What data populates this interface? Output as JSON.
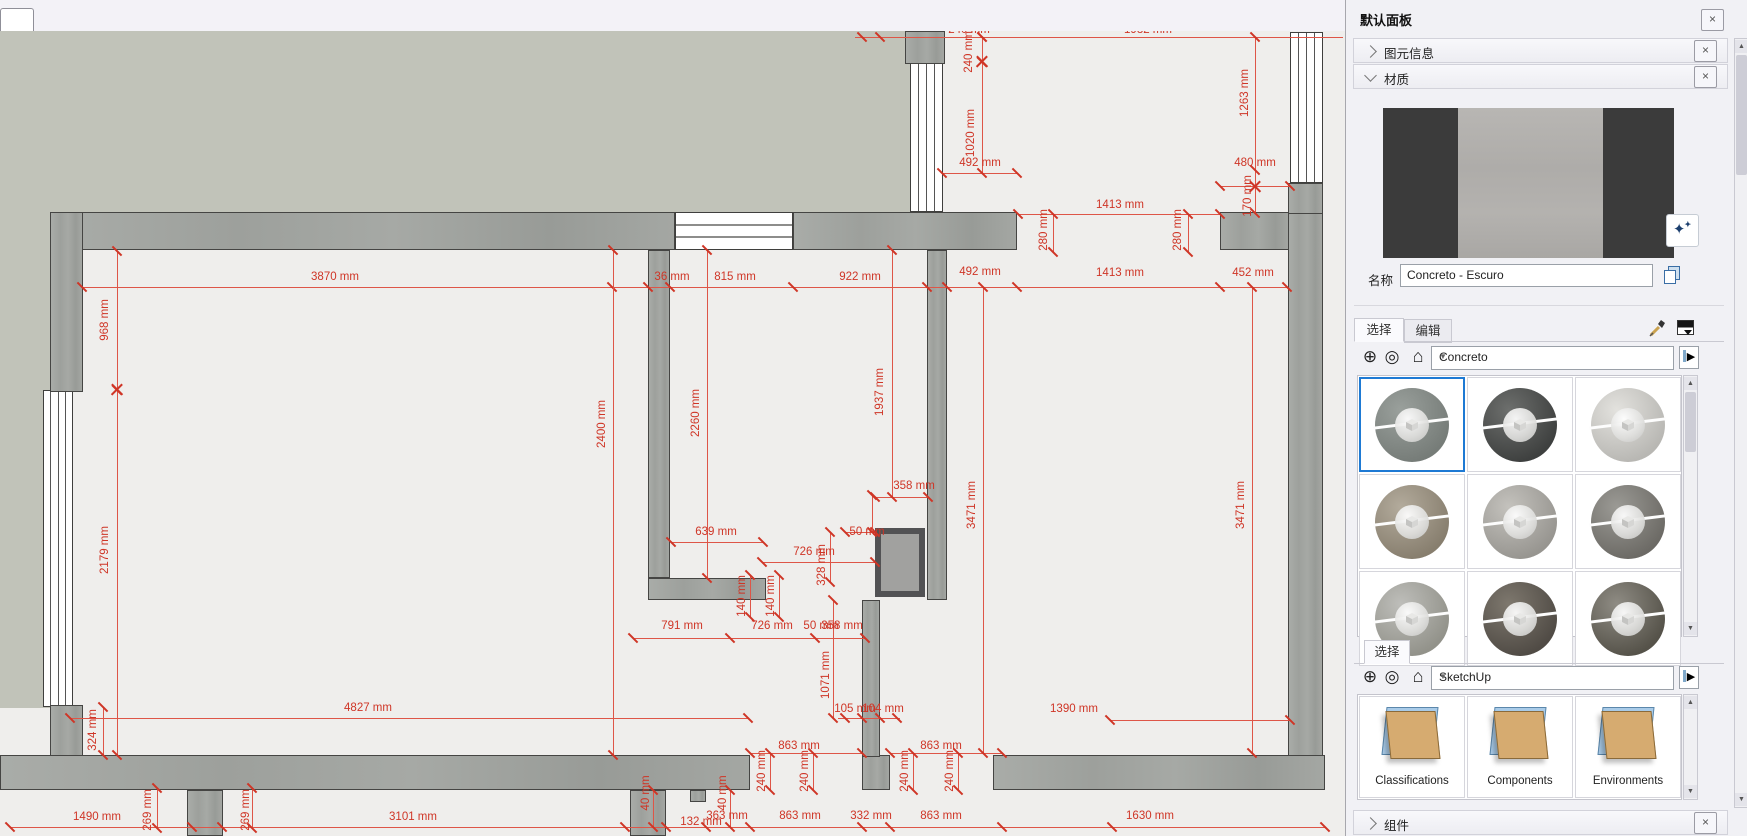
{
  "window": {
    "top_tab": ""
  },
  "panel": {
    "title": "默认面板",
    "close_label": "×",
    "sections": {
      "entity_info": {
        "label": "图元信息",
        "state": "collapsed"
      },
      "materials": {
        "label": "材质",
        "state": "expanded"
      },
      "components": {
        "label": "组件",
        "state": "collapsed"
      }
    },
    "materials": {
      "name_label": "名称",
      "material_name": "Concreto - Escuro",
      "tabs": [
        {
          "label": "选择",
          "active": true
        },
        {
          "label": "编辑",
          "active": false
        }
      ],
      "collection_dropdown": "Concreto",
      "accent_selection_color": "#1e7ad4",
      "thumbnails": [
        {
          "name": "concrete-gray",
          "c1": "#9aa09c",
          "c2": "#767c78",
          "selected": true
        },
        {
          "name": "concrete-cobble-dark",
          "c1": "#6d6f6d",
          "c2": "#3e403f",
          "selected": false
        },
        {
          "name": "concrete-light-smooth",
          "c1": "#e3e2de",
          "c2": "#b8b7b3",
          "selected": false
        },
        {
          "name": "concrete-speckled-tan",
          "c1": "#b3ab9c",
          "c2": "#877e6e",
          "selected": false
        },
        {
          "name": "concrete-light-gray",
          "c1": "#c4c2bd",
          "c2": "#979590",
          "selected": false
        },
        {
          "name": "concrete-mid-gray",
          "c1": "#9b9a95",
          "c2": "#6c6a65",
          "selected": false
        },
        {
          "name": "concrete-pale",
          "c1": "#bebeba",
          "c2": "#92928a",
          "selected": false
        },
        {
          "name": "concrete-dark-brown",
          "c1": "#7e786e",
          "c2": "#504b45",
          "selected": false
        },
        {
          "name": "concrete-coarse-dark",
          "c1": "#8f8c84",
          "c2": "#555249",
          "selected": false
        }
      ]
    },
    "browser": {
      "tab": "选择",
      "collection_dropdown": "SketchUp",
      "folders": [
        "Classifications",
        "Components",
        "Environments"
      ]
    }
  },
  "plan": {
    "dim_color": "#cf3526",
    "wall_color": "#a2a5a1",
    "ground_color": "#c1c3b9",
    "floor_color": "#efeeec",
    "grounds": [
      {
        "x": 0,
        "y": 31,
        "w": 910,
        "h": 181
      },
      {
        "x": 0,
        "y": 212,
        "w": 50,
        "h": 496
      }
    ],
    "walls": [
      {
        "x": 50,
        "y": 212,
        "w": 625,
        "h": 38
      },
      {
        "x": 793,
        "y": 212,
        "w": 224,
        "h": 38
      },
      {
        "x": 1220,
        "y": 212,
        "w": 70,
        "h": 38
      },
      {
        "x": 905,
        "y": 31,
        "w": 40,
        "h": 33
      },
      {
        "x": 1288,
        "y": 183,
        "w": 35,
        "h": 32
      },
      {
        "x": 1288,
        "y": 213,
        "w": 35,
        "h": 577
      },
      {
        "x": 50,
        "y": 212,
        "w": 33,
        "h": 180
      },
      {
        "x": 50,
        "y": 705,
        "w": 33,
        "h": 52
      },
      {
        "x": 0,
        "y": 755,
        "w": 750,
        "h": 35
      },
      {
        "x": 862,
        "y": 755,
        "w": 28,
        "h": 35
      },
      {
        "x": 993,
        "y": 755,
        "w": 332,
        "h": 35
      },
      {
        "x": 648,
        "y": 250,
        "w": 22,
        "h": 328
      },
      {
        "x": 648,
        "y": 578,
        "w": 118,
        "h": 22
      },
      {
        "x": 927,
        "y": 250,
        "w": 20,
        "h": 350
      },
      {
        "x": 862,
        "y": 600,
        "w": 18,
        "h": 157
      },
      {
        "x": 187,
        "y": 790,
        "w": 36,
        "h": 46
      },
      {
        "x": 630,
        "y": 790,
        "w": 36,
        "h": 46
      },
      {
        "x": 690,
        "y": 790,
        "w": 16,
        "h": 12
      }
    ],
    "windows": [
      {
        "x": 43,
        "y": 390,
        "w": 30,
        "h": 317
      },
      {
        "x": 910,
        "y": 62,
        "w": 33,
        "h": 150
      },
      {
        "x": 1290,
        "y": 32,
        "w": 33,
        "h": 151
      }
    ],
    "stairs": [
      {
        "x": 675,
        "y": 212,
        "w": 118,
        "h": 38
      }
    ],
    "closets": [
      {
        "x": 875,
        "y": 528,
        "w": 50,
        "h": 69
      }
    ],
    "dim_lines_h": [
      {
        "y": 287,
        "x1": 82,
        "x2": 1287,
        "ticks": [
          82,
          612,
          648,
          670,
          793,
          927,
          947,
          1017,
          1220,
          1287
        ]
      },
      {
        "y": 173,
        "x1": 942,
        "x2": 1017,
        "ticks": [
          942,
          1017
        ]
      },
      {
        "y": 186,
        "x1": 1220,
        "x2": 1290,
        "ticks": [
          1220,
          1290
        ]
      },
      {
        "y": 214,
        "x1": 1018,
        "x2": 1220,
        "ticks": [
          1018,
          1220
        ]
      },
      {
        "y": 497,
        "x1": 875,
        "x2": 928,
        "ticks": [
          875,
          928
        ]
      },
      {
        "y": 532,
        "x1": 845,
        "x2": 875,
        "ticks": [
          845,
          875
        ]
      },
      {
        "y": 542,
        "x1": 671,
        "x2": 763,
        "ticks": [
          671,
          763
        ]
      },
      {
        "y": 562,
        "x1": 762,
        "x2": 875,
        "ticks": [
          762,
          875
        ]
      },
      {
        "y": 638,
        "x1": 633,
        "x2": 865,
        "ticks": [
          633,
          730,
          815,
          865
        ]
      },
      {
        "y": 718,
        "x1": 70,
        "x2": 748,
        "ticks": [
          70,
          748
        ]
      },
      {
        "y": 718,
        "x1": 838,
        "x2": 900,
        "ticks": [
          845,
          862,
          880,
          897
        ]
      },
      {
        "y": 720,
        "x1": 1110,
        "x2": 1290,
        "ticks": [
          1110,
          1290
        ]
      },
      {
        "y": 753,
        "x1": 750,
        "x2": 862,
        "ticks": [
          750,
          862
        ]
      },
      {
        "y": 753,
        "x1": 890,
        "x2": 1002,
        "ticks": [
          890,
          1002
        ]
      },
      {
        "y": 827,
        "x1": 10,
        "x2": 1325,
        "ticks": [
          10,
          192,
          222,
          625,
          666,
          706,
          750,
          862,
          890,
          1002,
          1112,
          1325
        ]
      },
      {
        "y": 37,
        "x1": 855,
        "x2": 1343,
        "ticks": [
          862,
          880,
          982
        ]
      }
    ],
    "dim_lines_v": [
      {
        "x": 117,
        "y1": 251,
        "y2": 755,
        "ticks": [
          251,
          390,
          755
        ]
      },
      {
        "x": 613,
        "y1": 250,
        "y2": 755,
        "ticks": [
          250,
          755
        ]
      },
      {
        "x": 707,
        "y1": 250,
        "y2": 578,
        "ticks": [
          250,
          578
        ]
      },
      {
        "x": 892,
        "y1": 250,
        "y2": 497,
        "ticks": [
          250,
          497
        ]
      },
      {
        "x": 983,
        "y1": 287,
        "y2": 753,
        "ticks": [
          287,
          753
        ]
      },
      {
        "x": 1252,
        "y1": 287,
        "y2": 753,
        "ticks": [
          287,
          753
        ]
      },
      {
        "x": 833,
        "y1": 600,
        "y2": 718,
        "ticks": [
          600,
          718
        ]
      },
      {
        "x": 982,
        "y1": 37,
        "y2": 173,
        "ticks": [
          37,
          62,
          173
        ]
      },
      {
        "x": 1255,
        "y1": 37,
        "y2": 213,
        "ticks": [
          37,
          170,
          213
        ]
      },
      {
        "x": 103,
        "y1": 707,
        "y2": 755,
        "ticks": [
          707,
          755
        ]
      },
      {
        "x": 157,
        "y1": 788,
        "y2": 828,
        "ticks": [
          788,
          828
        ]
      },
      {
        "x": 252,
        "y1": 788,
        "y2": 828,
        "ticks": [
          788,
          828
        ]
      },
      {
        "x": 770,
        "y1": 753,
        "y2": 790,
        "ticks": [
          753,
          790
        ]
      },
      {
        "x": 813,
        "y1": 753,
        "y2": 790,
        "ticks": [
          753,
          790
        ]
      },
      {
        "x": 913,
        "y1": 753,
        "y2": 790,
        "ticks": [
          753,
          790
        ]
      },
      {
        "x": 958,
        "y1": 753,
        "y2": 790,
        "ticks": [
          753,
          790
        ]
      },
      {
        "x": 653,
        "y1": 790,
        "y2": 827,
        "ticks": [
          790,
          827
        ]
      },
      {
        "x": 730,
        "y1": 790,
        "y2": 827,
        "ticks": [
          790,
          827
        ]
      },
      {
        "x": 750,
        "y1": 575,
        "y2": 617,
        "ticks": [
          575,
          617
        ]
      },
      {
        "x": 779,
        "y1": 575,
        "y2": 617,
        "ticks": [
          575,
          617
        ]
      },
      {
        "x": 830,
        "y1": 532,
        "y2": 582,
        "ticks": [
          532,
          582
        ]
      },
      {
        "x": 1053,
        "y1": 214,
        "y2": 252,
        "ticks": [
          214,
          252
        ]
      },
      {
        "x": 1188,
        "y1": 214,
        "y2": 252,
        "ticks": [
          214,
          252
        ]
      },
      {
        "x": 872,
        "y1": 495,
        "y2": 532,
        "ticks": [
          495,
          532
        ]
      }
    ],
    "x_marks": [
      {
        "x": 117,
        "y": 390
      },
      {
        "x": 982,
        "y": 62
      },
      {
        "x": 1255,
        "y": 187
      }
    ],
    "dim_labels": [
      {
        "t": "3870 mm",
        "x": 335,
        "y": 277
      },
      {
        "t": "36 mm",
        "x": 672,
        "y": 277
      },
      {
        "t": "815 mm",
        "x": 735,
        "y": 277
      },
      {
        "t": "922 mm",
        "x": 860,
        "y": 277
      },
      {
        "t": "492 mm",
        "x": 980,
        "y": 272
      },
      {
        "t": "1413 mm",
        "x": 1120,
        "y": 273
      },
      {
        "t": "452 mm",
        "x": 1253,
        "y": 273
      },
      {
        "t": "492 mm",
        "x": 980,
        "y": 163
      },
      {
        "t": "480 mm",
        "x": 1255,
        "y": 163
      },
      {
        "t": "1413 mm",
        "x": 1120,
        "y": 205
      },
      {
        "t": "358 mm",
        "x": 914,
        "y": 486
      },
      {
        "t": "639 mm",
        "x": 716,
        "y": 532
      },
      {
        "t": "50 mm",
        "x": 867,
        "y": 532
      },
      {
        "t": "726 mm",
        "x": 814,
        "y": 552
      },
      {
        "t": "791 mm",
        "x": 682,
        "y": 626
      },
      {
        "t": "726 mm",
        "x": 772,
        "y": 626
      },
      {
        "t": "50 mm",
        "x": 821,
        "y": 626
      },
      {
        "t": "358 mm",
        "x": 842,
        "y": 626
      },
      {
        "t": "4827 mm",
        "x": 368,
        "y": 708
      },
      {
        "t": "105 mm",
        "x": 855,
        "y": 709
      },
      {
        "t": "104 mm",
        "x": 883,
        "y": 709
      },
      {
        "t": "1390 mm",
        "x": 1074,
        "y": 709
      },
      {
        "t": "863 mm",
        "x": 799,
        "y": 746
      },
      {
        "t": "863 mm",
        "x": 941,
        "y": 746
      },
      {
        "t": "1490 mm",
        "x": 97,
        "y": 817
      },
      {
        "t": "3101 mm",
        "x": 413,
        "y": 817
      },
      {
        "t": "132 mm",
        "x": 701,
        "y": 822
      },
      {
        "t": "363 mm",
        "x": 727,
        "y": 816
      },
      {
        "t": "863 mm",
        "x": 800,
        "y": 816
      },
      {
        "t": "332 mm",
        "x": 871,
        "y": 816
      },
      {
        "t": "863 mm",
        "x": 941,
        "y": 816
      },
      {
        "t": "1630 mm",
        "x": 1150,
        "y": 816
      },
      {
        "t": "240 mm",
        "x": 969,
        "y": 30
      },
      {
        "t": "1982 mm",
        "x": 1148,
        "y": 30
      },
      {
        "t": "968 mm",
        "x": 105,
        "y": 320,
        "rot": 1
      },
      {
        "t": "2179 mm",
        "x": 105,
        "y": 550,
        "rot": 1
      },
      {
        "t": "2400 mm",
        "x": 602,
        "y": 424,
        "rot": 1
      },
      {
        "t": "2260 mm",
        "x": 696,
        "y": 413,
        "rot": 1
      },
      {
        "t": "1937 mm",
        "x": 880,
        "y": 392,
        "rot": 1
      },
      {
        "t": "3471 mm",
        "x": 972,
        "y": 505,
        "rot": 1
      },
      {
        "t": "3471 mm",
        "x": 1241,
        "y": 505,
        "rot": 1
      },
      {
        "t": "1071 mm",
        "x": 826,
        "y": 675,
        "rot": 1
      },
      {
        "t": "1020 mm",
        "x": 971,
        "y": 133,
        "rot": 1
      },
      {
        "t": "240 mm",
        "x": 969,
        "y": 52,
        "rot": 1
      },
      {
        "t": "1263 mm",
        "x": 1245,
        "y": 93,
        "rot": 1
      },
      {
        "t": "170 mm",
        "x": 1248,
        "y": 196,
        "rot": 1
      },
      {
        "t": "280 mm",
        "x": 1044,
        "y": 230,
        "rot": 1
      },
      {
        "t": "280 mm",
        "x": 1178,
        "y": 230,
        "rot": 1
      },
      {
        "t": "324 mm",
        "x": 93,
        "y": 730,
        "rot": 1
      },
      {
        "t": "269 mm",
        "x": 148,
        "y": 810,
        "rot": 1
      },
      {
        "t": "269 mm",
        "x": 246,
        "y": 810,
        "rot": 1
      },
      {
        "t": "240 mm",
        "x": 762,
        "y": 771,
        "rot": 1
      },
      {
        "t": "240 mm",
        "x": 805,
        "y": 771,
        "rot": 1
      },
      {
        "t": "240 mm",
        "x": 905,
        "y": 771,
        "rot": 1
      },
      {
        "t": "240 mm",
        "x": 950,
        "y": 771,
        "rot": 1
      },
      {
        "t": "40 mm",
        "x": 646,
        "y": 793,
        "rot": 1
      },
      {
        "t": "40 mm",
        "x": 723,
        "y": 793,
        "rot": 1
      },
      {
        "t": "140 mm",
        "x": 742,
        "y": 596,
        "rot": 1
      },
      {
        "t": "140 mm",
        "x": 771,
        "y": 596,
        "rot": 1
      },
      {
        "t": "328 mm",
        "x": 822,
        "y": 565,
        "rot": 1
      }
    ],
    "float_toolbar": {
      "dots": "...",
      "close": "×"
    }
  }
}
